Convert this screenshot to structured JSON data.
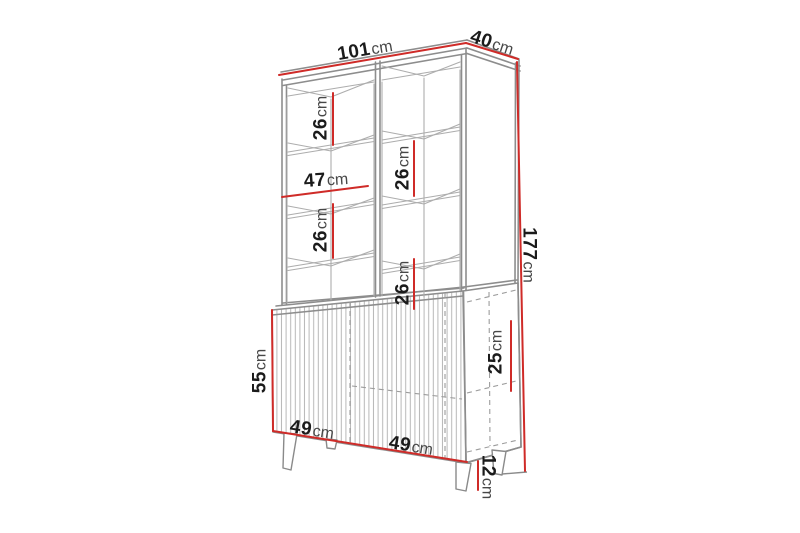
{
  "figure": {
    "type": "furniture-dimension-diagram",
    "subject": "tall display cabinet with open shelving on top and fluted sideboard base on legs"
  },
  "colors": {
    "dimension_red": "#cf2b28",
    "line_gray": "#8d8d8d",
    "interior_gray": "#adadad",
    "text_dark": "#1b1b1b",
    "unit_gray": "#474747",
    "background": "#ffffff"
  },
  "dims": {
    "width": {
      "value": "101",
      "unit": "cm"
    },
    "depth": {
      "value": "40",
      "unit": "cm"
    },
    "height": {
      "value": "177",
      "unit": "cm"
    },
    "shelf_left_top": {
      "value": "26",
      "unit": "cm"
    },
    "left_inner_width": {
      "value": "47",
      "unit": "cm"
    },
    "shelf_left_mid": {
      "value": "26",
      "unit": "cm"
    },
    "shelf_right_upper": {
      "value": "26",
      "unit": "cm"
    },
    "shelf_right_lower": {
      "value": "26",
      "unit": "cm"
    },
    "base_height": {
      "value": "55",
      "unit": "cm"
    },
    "base_right_inner": {
      "value": "25",
      "unit": "cm"
    },
    "base_door_left": {
      "value": "49",
      "unit": "cm"
    },
    "base_door_right": {
      "value": "49",
      "unit": "cm"
    },
    "leg_height": {
      "value": "12",
      "unit": "cm"
    }
  }
}
